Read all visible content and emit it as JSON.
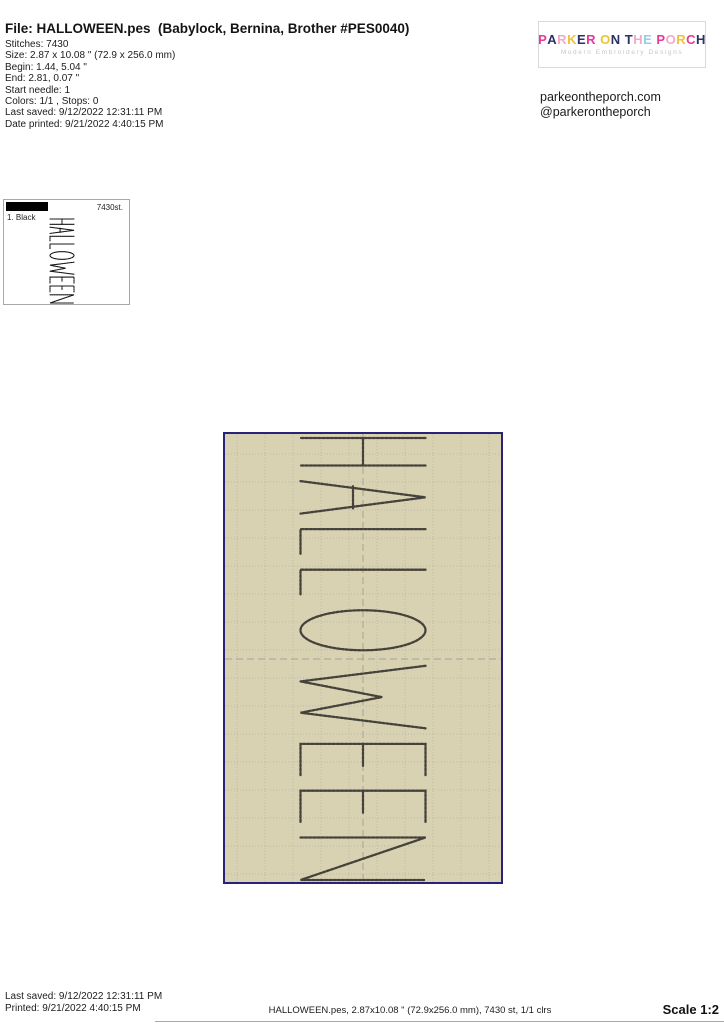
{
  "header": {
    "file_label": "File: HALLOWEEN.pes  (Babylock, Bernina, Brother #PES0040)",
    "details": [
      "Stitches: 7430",
      "Size: 2.87 x 10.08 \" (72.9 x 256.0 mm)",
      "Begin: 1.44, 5.04 \"",
      "End: 2.81, 0.07 \"",
      "Start needle: 1",
      "Colors: 1/1 , Stops: 0",
      "Last saved: 9/12/2022 12:31:11 PM",
      "Date printed: 9/21/2022 4:40:15 PM"
    ]
  },
  "brand": {
    "logo_title": "PARKER ON THE PORCH",
    "logo_colors": [
      "#e5399b",
      "#2b3166",
      "#f2aac8",
      "#efc332",
      "#2b3166",
      "#e5399b",
      null,
      "#efc332",
      "#2b3166",
      null,
      "#2b3166",
      "#f2aac8",
      "#8fd2e8",
      null,
      "#e5399b",
      "#f2aac8",
      "#efc332",
      "#e5399b",
      "#2b3166"
    ],
    "logo_subtitle": "Modern Embroidery Designs",
    "website": "parkeontheporch.com",
    "social": "@parkerontheporch"
  },
  "thumbnail": {
    "color_index_label": "1. Black",
    "stitch_count_label": "7430st.",
    "swatch_color": "#000000",
    "thread_color": "#151515"
  },
  "design": {
    "word": "HALLOWEEN",
    "background_color": "#d8d1b2",
    "border_color": "#262378",
    "grid_color": "#bdb9a8",
    "center_line_color": "#a6a296",
    "thread_color": "#44423a"
  },
  "footer": {
    "last_saved": "Last saved: 9/12/2022 12:31:11 PM",
    "printed": "Printed: 9/21/2022 4:40:15 PM",
    "summary": "HALLOWEEN.pes, 2.87x10.08 \" (72.9x256.0 mm), 7430 st, 1/1 clrs",
    "scale_label": "Scale 1:2"
  }
}
